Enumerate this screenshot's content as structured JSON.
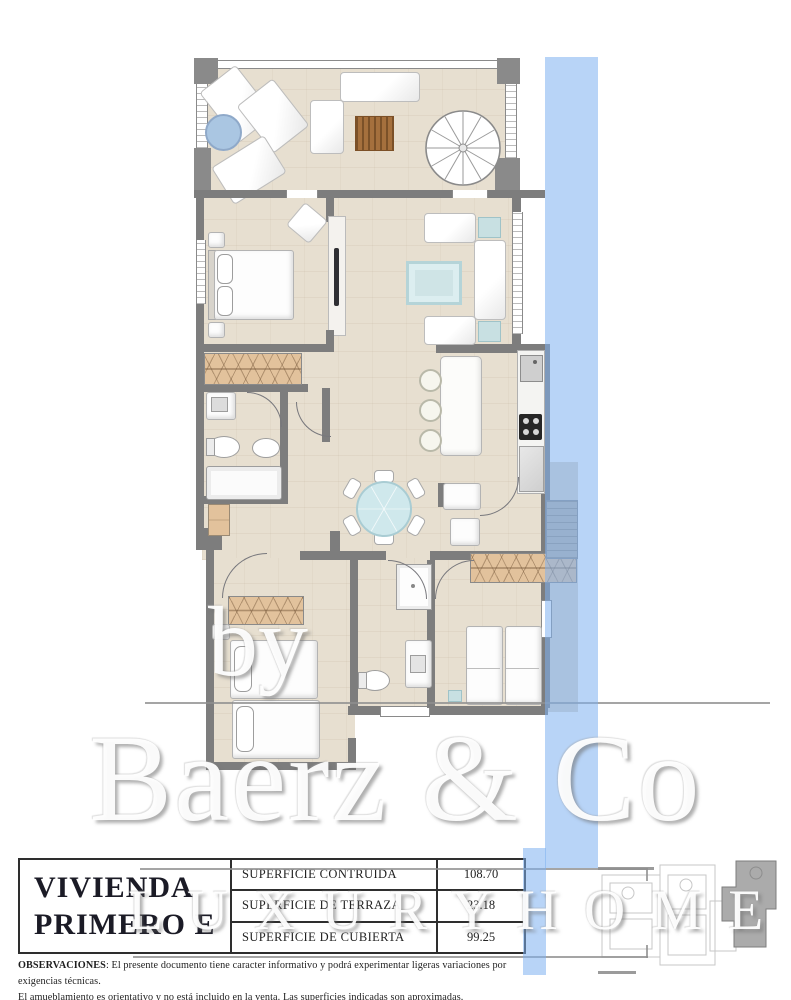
{
  "title_block": {
    "title_line1": "VIVIENDA",
    "title_line2": "PRIMERO E",
    "rows": [
      {
        "label": "SUPERFICIE CONTRUIDA",
        "value": "108.70"
      },
      {
        "label": "SUPERFICIE DE TERRAZA",
        "value": "23.18"
      },
      {
        "label": "SUPERFICIE DE CUBIERTA",
        "value": "99.25"
      }
    ]
  },
  "observations": {
    "label": "OBSERVACIONES",
    "line1_rest": ": El presente documento tiene caracter informativo y podrá experimentar ligeras variaciones por exigencias técnicas.",
    "line2": "El amueblamiento es orientativo y no está incluido en la venta. Las superficies indicadas son aproximadas."
  },
  "watermark": {
    "by": "by",
    "brand": "Baerz & Co",
    "tagline": "L U X U R Y   H O M E S"
  },
  "colors": {
    "highlight_blue": "#7eb1f0",
    "wall_gray": "#7d7d7d",
    "floor_beige": "#e7dfd0",
    "wood_tan": "#e2c29c",
    "accent_teal": "#c8e0e2"
  },
  "floor_plan": {
    "rooms": [
      "solarium-terrace",
      "master-bedroom",
      "living-room",
      "kitchen",
      "dining-area",
      "hallway",
      "bathroom-1",
      "bathroom-2",
      "bedroom-2",
      "bedroom-3",
      "side-terrace"
    ],
    "features": [
      "spiral-staircase",
      "kitchen-island",
      "bar-stools",
      "cooktop",
      "sink",
      "bathtub",
      "shower",
      "toilet",
      "bidet",
      "double-bed",
      "single-beds",
      "wardrobes",
      "sun-loungers",
      "sofas",
      "dining-table"
    ]
  }
}
